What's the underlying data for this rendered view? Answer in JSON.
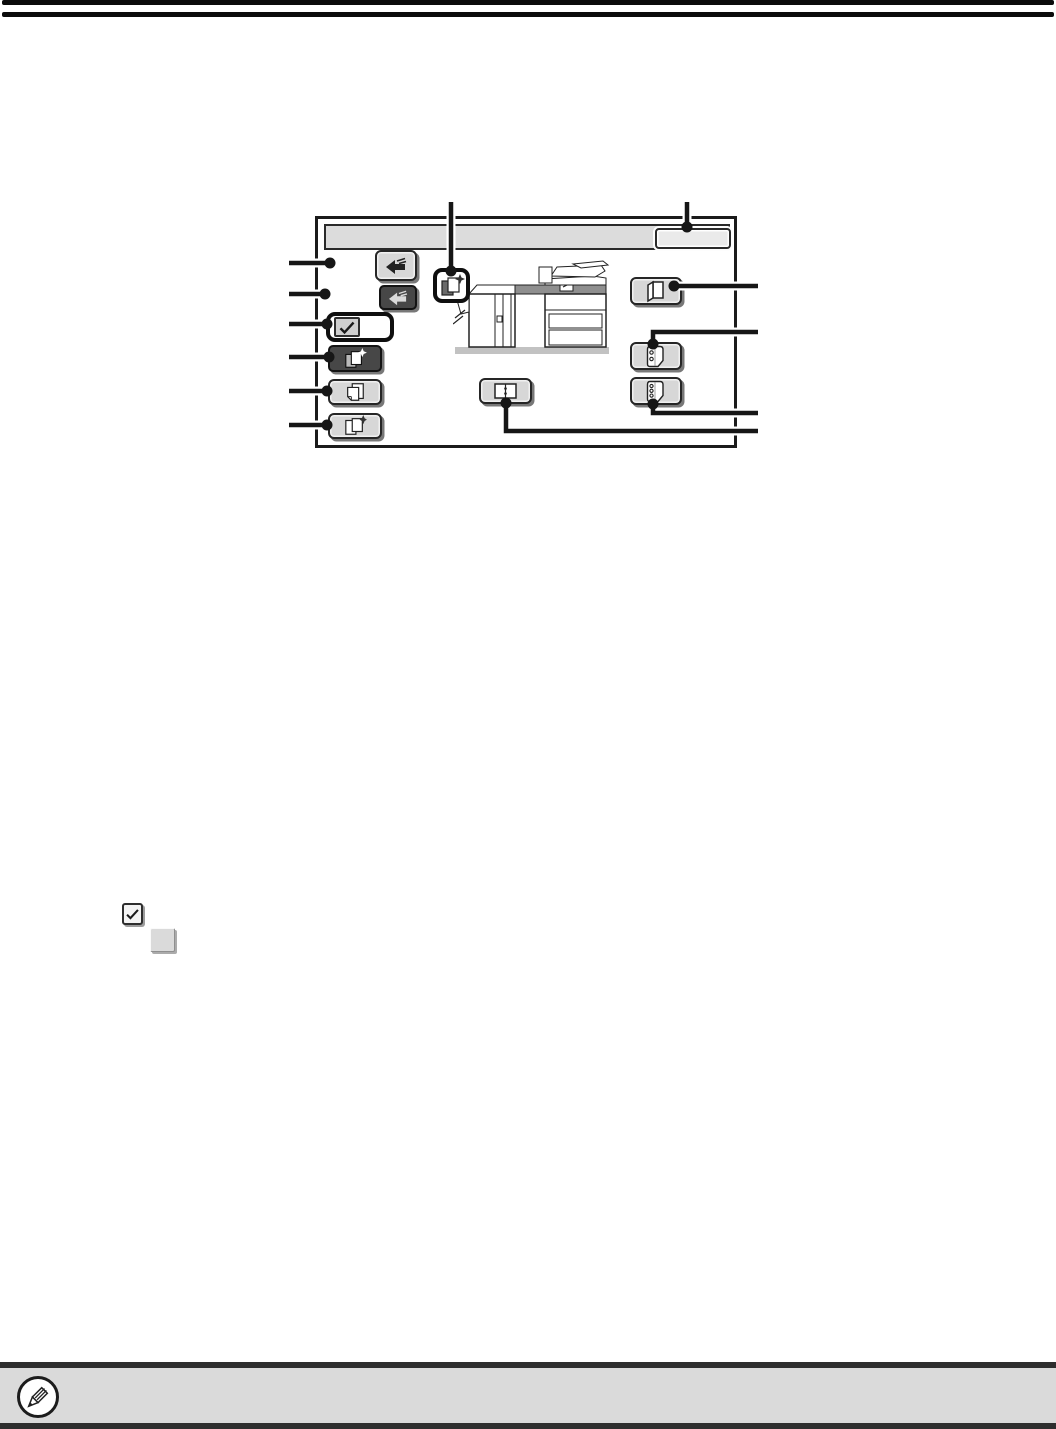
{
  "page": {
    "kind": "manual-page-diagram",
    "background": "#ffffff",
    "visible_text": ""
  },
  "top_rules": {
    "count": 2,
    "color": "#0b0b0b"
  },
  "screen_diagram": {
    "frame_color": "#1b1b1b",
    "header": {
      "fill": "#dcdcdc",
      "text": ""
    },
    "ok_key": {
      "fill": "#eaeaea",
      "label": "",
      "icon": "blank-key"
    },
    "callout": {
      "color": "#161616",
      "left_lines": 6,
      "top_lines": 2,
      "right_lines": 4
    },
    "machine_image": "copier-line-art",
    "framed_mini_icon": "pages-with-star-icon",
    "keys": [
      {
        "id": "upper-arrow-key",
        "icon": "arrow-left-icon",
        "state": "normal",
        "fill": "#d7d7d7"
      },
      {
        "id": "lower-arrow-key",
        "icon": "arrow-left-icon",
        "state": "selected",
        "fill": "#474747"
      },
      {
        "id": "framed-check-key",
        "icon": "checkmark-icon",
        "state": "bold-framed",
        "fill": "#ffffff"
      },
      {
        "id": "pages-star-key",
        "icon": "pages-with-star-icon",
        "state": "selected",
        "fill": "#474747"
      },
      {
        "id": "two-pages-key",
        "icon": "two-pages-icon",
        "state": "normal",
        "fill": "#d7d7d7"
      },
      {
        "id": "page-star-key",
        "icon": "page-with-star-icon",
        "state": "normal",
        "fill": "#d7d7d7"
      },
      {
        "id": "folded-sheet-key",
        "icon": "folded-sheet-icon",
        "state": "normal",
        "fill": "#d7d7d7"
      },
      {
        "id": "two-hole-sheet-key",
        "icon": "sheet-two-holes-icon",
        "state": "normal",
        "fill": "#d7d7d7"
      },
      {
        "id": "three-hole-sheet-key",
        "icon": "sheet-three-holes-icon",
        "state": "normal",
        "fill": "#d7d7d7"
      },
      {
        "id": "open-book-key",
        "icon": "open-book-icon",
        "state": "normal",
        "fill": "#d7d7d7"
      }
    ]
  },
  "inline_glyphs": [
    {
      "id": "checked-key",
      "icon": "checkmark-icon",
      "fill": "#f4f4f4"
    },
    {
      "id": "blank-key",
      "icon": "blank",
      "fill": "#dadada"
    }
  ],
  "note_bar": {
    "fill": "#dadada",
    "border_color": "#2e2e2e",
    "icon": "pencil-icon",
    "text": ""
  }
}
